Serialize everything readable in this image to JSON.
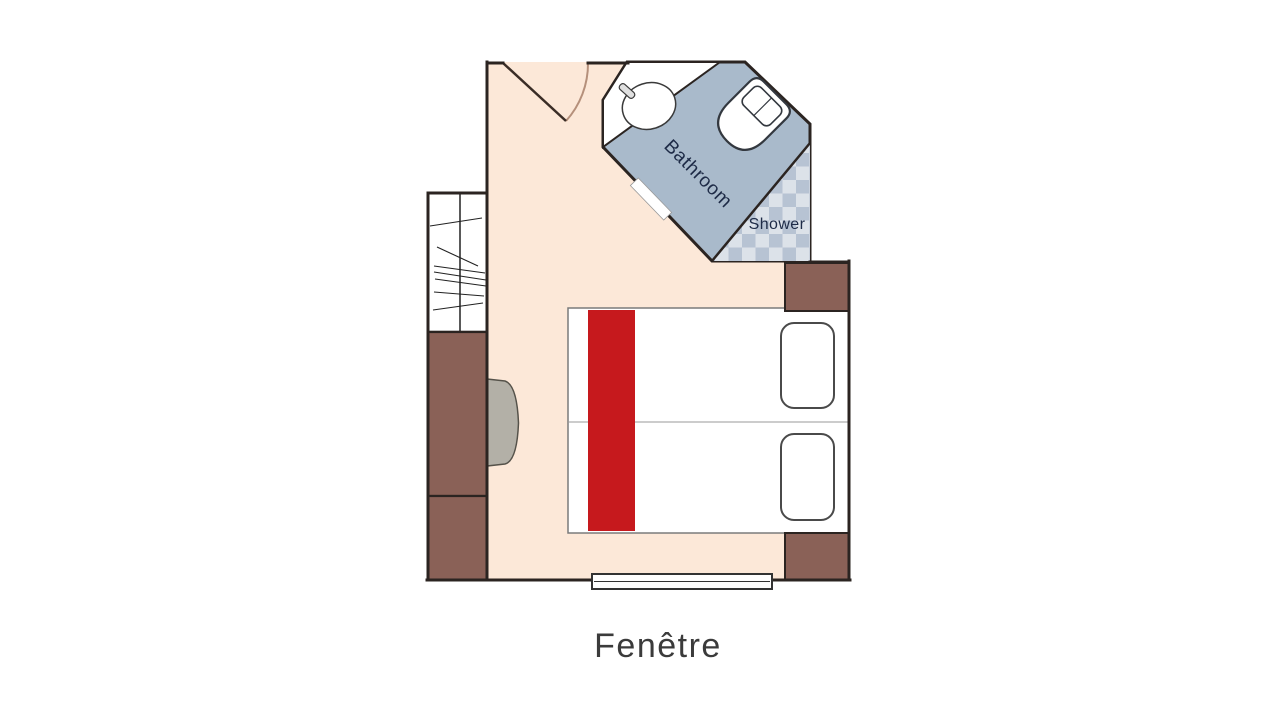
{
  "plan": {
    "labels": {
      "bathroom": "Bathroom",
      "shower": "Shower",
      "window_caption": "Fenêtre"
    },
    "colors": {
      "background": "#ffffff",
      "floor": "#fce8d8",
      "wall": "#2b2421",
      "bathroom_floor": "#a9bacb",
      "shower_check_dark": "#b7c3d3",
      "shower_check_light": "#dce2e9",
      "furniture_brown": "#8a6157",
      "bed_runner_red": "#c6191d",
      "armchair_gray": "#b3b0a7",
      "fixture_white": "#ffffff",
      "label_navy": "#1e2b47",
      "caption_gray": "#3b3b3b",
      "door_swing_arc": "#b5907b"
    },
    "features": [
      "entry-door",
      "wardrobe",
      "cabinets",
      "armchair",
      "twin-beds",
      "bed-runner",
      "pillows",
      "nightstands",
      "bathroom",
      "sink",
      "toilet",
      "shower",
      "window"
    ]
  }
}
